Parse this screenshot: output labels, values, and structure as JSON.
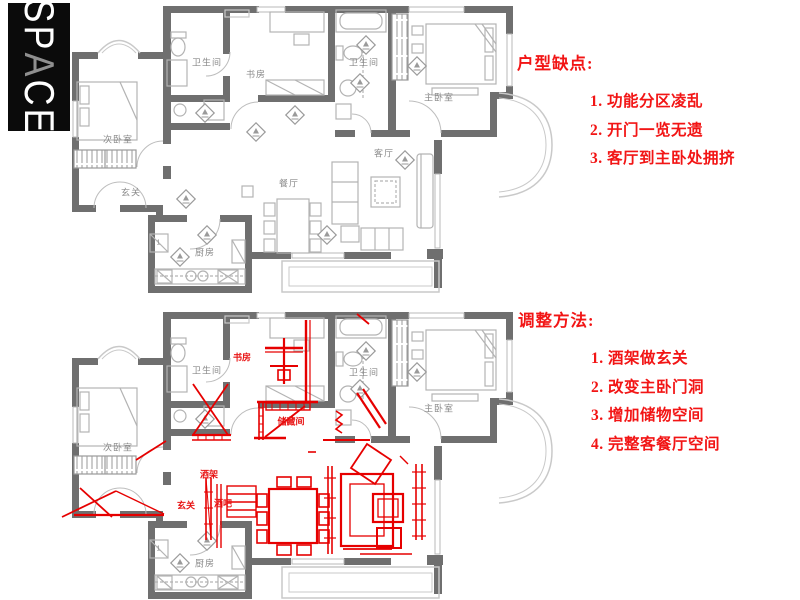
{
  "logo": {
    "text": "SPACE",
    "letters": [
      "S",
      "P",
      "A",
      "C",
      "E"
    ]
  },
  "panels": {
    "issues": {
      "title": "户型缺点:",
      "items": [
        "1. 功能分区凌乱",
        "2. 开门一览无遗",
        "3. 客厅到主卧处拥挤"
      ]
    },
    "methods": {
      "title": "调整方法:",
      "items": [
        "1. 酒架做玄关",
        "2. 改变主卧门洞",
        "3. 增加储物空间",
        "4. 完整客餐厅空间"
      ]
    }
  },
  "plans": {
    "original": {
      "name": "原始户型图",
      "labels": [
        {
          "text": "卫生间",
          "x": 147,
          "y": 60
        },
        {
          "text": "书房",
          "x": 196,
          "y": 72
        },
        {
          "text": "卫生间",
          "x": 304,
          "y": 60
        },
        {
          "text": "主卧室",
          "x": 379,
          "y": 95
        },
        {
          "text": "次卧室",
          "x": 58,
          "y": 137
        },
        {
          "text": "玄关",
          "x": 71,
          "y": 190
        },
        {
          "text": "餐厅",
          "x": 229,
          "y": 181
        },
        {
          "text": "客厅",
          "x": 324,
          "y": 151
        },
        {
          "text": "厨房",
          "x": 145,
          "y": 250
        },
        {
          "text": "1",
          "x": 99,
          "y": 241,
          "s": 7
        }
      ]
    },
    "adjusted": {
      "name": "调整后户型图",
      "labels": [
        {
          "text": "卫生间",
          "x": 147,
          "y": 62
        },
        {
          "text": "卫生间",
          "x": 304,
          "y": 64
        },
        {
          "text": "主卧室",
          "x": 379,
          "y": 100
        },
        {
          "text": "次卧室",
          "x": 58,
          "y": 139
        },
        {
          "text": "厨房",
          "x": 145,
          "y": 255
        },
        {
          "text": "1",
          "x": 99,
          "y": 241,
          "s": 7
        }
      ],
      "labels_red": [
        {
          "text": "书房",
          "x": 182,
          "y": 49
        },
        {
          "text": "储藏间",
          "x": 231,
          "y": 113
        },
        {
          "text": "酒架",
          "x": 149,
          "y": 166
        },
        {
          "text": "玄关",
          "x": 126,
          "y": 197
        },
        {
          "text": "酒吧",
          "x": 163,
          "y": 195
        }
      ]
    }
  },
  "colors": {
    "wall_gray": "#6f6f6f",
    "fixture_gray": "#b3b3b3",
    "light_gray": "#c9c9c9",
    "room_label_gray": "#8a8a8a",
    "annotation_red": "#e60000",
    "label_red": "#e81414",
    "panel_text_red": "#f21515",
    "logo_bg": "#0b0b0b",
    "logo_accent": "#8f8f8f"
  }
}
